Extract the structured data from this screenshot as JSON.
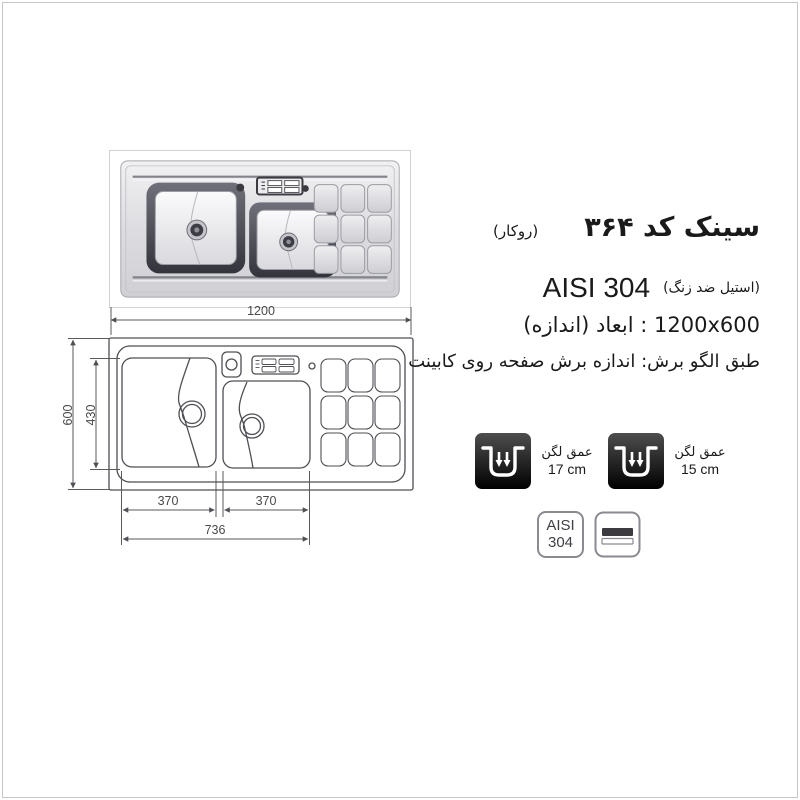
{
  "info": {
    "title": "سینک کد ۳۶۴",
    "mount_note": "(روکار)",
    "steel_note": "(استیل ضد زنگ)",
    "steel_grade": "AISI 304",
    "size_line": "1200x600 : ابعاد (اندازه)",
    "cut_line": "طبق الگو برش: اندازه برش صفحه روی کابینت",
    "depth_items": [
      {
        "label": "عمق لگن",
        "value": "17 cm"
      },
      {
        "label": "عمق لگن",
        "value": "15 cm"
      }
    ],
    "aisi_badge": {
      "line1": "AISI",
      "line2": "304"
    }
  },
  "diagram": {
    "overall_width": "1200",
    "overall_depth": "600",
    "bowl_depth_span": "430",
    "bowl1_width": "370",
    "bowl2_width": "370",
    "bowls_span": "736"
  },
  "colors": {
    "line": "#4f4f55",
    "dim_text": "#4a4a4a",
    "icon_black": "#000000",
    "page_border": "#c6c6c6"
  }
}
